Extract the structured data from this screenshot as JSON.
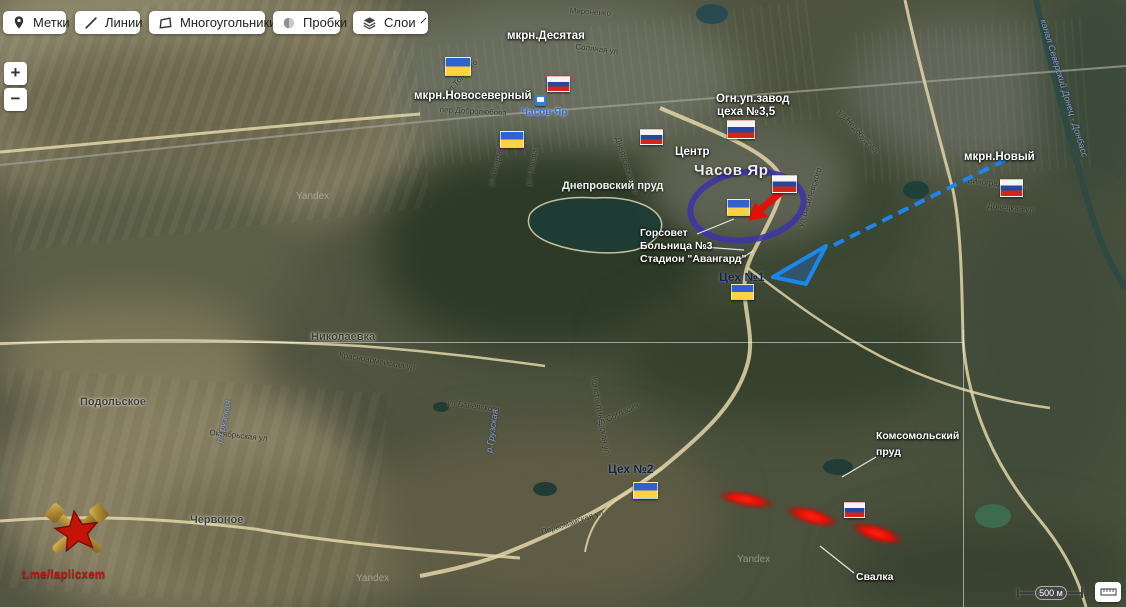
{
  "toolbar": {
    "buttons": [
      {
        "id": "marks",
        "label": "Метки",
        "icon": "pin-icon"
      },
      {
        "id": "lines",
        "label": "Линии",
        "icon": "line-icon"
      },
      {
        "id": "polygons",
        "label": "Многоугольники",
        "icon": "polygon-icon"
      },
      {
        "id": "traffic",
        "label": "Пробки",
        "icon": "traffic-icon"
      },
      {
        "id": "layers",
        "label": "Слои",
        "icon": "layers-icon",
        "has_dropdown": true
      }
    ]
  },
  "zoom": {
    "in": "+",
    "out": "−"
  },
  "scalebar": {
    "label": "500 м"
  },
  "logo": {
    "text": "t.me/laplicxem"
  },
  "map": {
    "city_labels": [
      {
        "text": "Часов Яр",
        "x": 694,
        "y": 162
      }
    ],
    "settlement_labels": [
      {
        "text": "Николаевка",
        "x": 311,
        "y": 331
      },
      {
        "text": "Подольское",
        "x": 80,
        "y": 396
      },
      {
        "text": "Червоное",
        "x": 190,
        "y": 514
      }
    ],
    "water_labels": [
      {
        "text": "Днепровский пруд",
        "x": 562,
        "y": 180,
        "cls": "pond"
      },
      {
        "text": "канал Северский Донец - Донбасс",
        "x": 1048,
        "y": 18,
        "rot": 73,
        "cls": "river"
      },
      {
        "text": "р.Грузская",
        "x": 214,
        "y": 442,
        "rot": -78,
        "cls": "river"
      },
      {
        "text": "р.Грузская",
        "x": 484,
        "y": 452,
        "rot": -82,
        "cls": "river"
      }
    ],
    "station": {
      "text": "Часов Яр",
      "x": 521,
      "y": 107,
      "icon_x": 535,
      "icon_y": 95
    },
    "annotations": [
      {
        "text": "мкрн.Десятая",
        "x": 507,
        "y": 30,
        "cls": "white"
      },
      {
        "text": "мкрн.Новосеверный",
        "x": 414,
        "y": 90,
        "cls": "white"
      },
      {
        "text": "Огн.уп.завод",
        "x": 716,
        "y": 93,
        "cls": "white"
      },
      {
        "text": "цеха №3,5",
        "x": 717,
        "y": 106,
        "cls": "white"
      },
      {
        "text": "Центр",
        "x": 675,
        "y": 146,
        "cls": "white"
      },
      {
        "text": "мкрн.Новый",
        "x": 964,
        "y": 151,
        "cls": "white"
      },
      {
        "text": "Горсовет",
        "x": 640,
        "y": 227,
        "cls": "white-sm"
      },
      {
        "text": "Больница №3",
        "x": 640,
        "y": 240,
        "cls": "white-sm"
      },
      {
        "text": "Стадион \"Авангард\"",
        "x": 640,
        "y": 253,
        "cls": "white-sm"
      },
      {
        "text": "Комсомольский",
        "x": 876,
        "y": 430,
        "cls": "white-sm"
      },
      {
        "text": "пруд",
        "x": 876,
        "y": 446,
        "cls": "white-sm"
      },
      {
        "text": "Свалка",
        "x": 856,
        "y": 571,
        "cls": "white-sm"
      },
      {
        "text": "Цех №1",
        "x": 719,
        "y": 270,
        "cls": "dark"
      },
      {
        "text": "Цех №2",
        "x": 608,
        "y": 462,
        "cls": "dark"
      }
    ],
    "street_labels": [
      {
        "text": "Мироненко",
        "x": 570,
        "y": 6,
        "rot": 4
      },
      {
        "text": "Соляная ул",
        "x": 576,
        "y": 42,
        "rot": 7
      },
      {
        "text": "пер.Добролюбова",
        "x": 440,
        "y": 105,
        "rot": 3
      },
      {
        "text": "ул.Толстого",
        "x": 444,
        "y": 90,
        "rot": -48
      },
      {
        "text": "ул.Спартака",
        "x": 486,
        "y": 185,
        "rot": -75
      },
      {
        "text": "ул.Чехова",
        "x": 524,
        "y": 185,
        "rot": -80
      },
      {
        "text": "Днепровская ул",
        "x": 622,
        "y": 136,
        "rot": 72
      },
      {
        "text": "ул.Недобудова",
        "x": 843,
        "y": 108,
        "rot": 48
      },
      {
        "text": "ул.Василевского",
        "x": 796,
        "y": 225,
        "rot": -72
      },
      {
        "text": "Виноградная ул",
        "x": 968,
        "y": 176,
        "rot": 6
      },
      {
        "text": "Донецкая ул",
        "x": 988,
        "y": 201,
        "rot": 6
      },
      {
        "text": "Красноармейская ул",
        "x": 340,
        "y": 350,
        "rot": 10
      },
      {
        "text": "Константиновская ул",
        "x": 598,
        "y": 376,
        "rot": 80
      },
      {
        "text": "ул.Баневского",
        "x": 448,
        "y": 398,
        "rot": 8
      },
      {
        "text": "ул.Согласия",
        "x": 595,
        "y": 420,
        "rot": -25
      },
      {
        "text": "Октябрьская ул",
        "x": 210,
        "y": 428,
        "rot": 6
      },
      {
        "text": "Первомайская ул",
        "x": 540,
        "y": 528,
        "rot": -18
      }
    ],
    "watermarks": [
      {
        "text": "Yandex",
        "x": 296,
        "y": 191
      },
      {
        "text": "Yandex",
        "x": 356,
        "y": 573
      },
      {
        "text": "Yandex",
        "x": 737,
        "y": 554
      }
    ],
    "flags": [
      {
        "type": "ua",
        "x": 445,
        "y": 57,
        "w": 26,
        "h": 19
      },
      {
        "type": "ua",
        "x": 500,
        "y": 131,
        "w": 24,
        "h": 17
      },
      {
        "type": "ua",
        "x": 727,
        "y": 199,
        "w": 23,
        "h": 17
      },
      {
        "type": "ua",
        "x": 731,
        "y": 284,
        "w": 23,
        "h": 16
      },
      {
        "type": "ua",
        "x": 633,
        "y": 482,
        "w": 25,
        "h": 17
      },
      {
        "type": "ru",
        "x": 547,
        "y": 76,
        "w": 23,
        "h": 16
      },
      {
        "type": "ru",
        "x": 640,
        "y": 129,
        "w": 23,
        "h": 16
      },
      {
        "type": "ru",
        "x": 727,
        "y": 120,
        "w": 28,
        "h": 19
      },
      {
        "type": "ru",
        "x": 772,
        "y": 175,
        "w": 25,
        "h": 18
      },
      {
        "type": "ru",
        "x": 1000,
        "y": 179,
        "w": 23,
        "h": 18
      },
      {
        "type": "ru",
        "x": 844,
        "y": 502,
        "w": 21,
        "h": 16
      }
    ]
  },
  "overlays": {
    "ellipse": {
      "cx": 747,
      "cy": 206,
      "rx": 57,
      "ry": 34,
      "rot": -8,
      "color": "#3c34a9"
    },
    "red_arrow": {
      "shaft": [
        [
          786,
          188
        ],
        [
          761,
          209
        ]
      ],
      "head": [
        [
          748,
          221
        ],
        [
          755,
          202
        ],
        [
          768,
          217
        ]
      ],
      "color": "#e31006"
    },
    "blue_arrow": {
      "line": [
        [
          1005,
          160
        ],
        [
          830,
          247
        ]
      ],
      "head": [
        [
          773,
          277
        ],
        [
          826,
          246
        ],
        [
          806,
          284
        ]
      ],
      "color": "#1b86ec"
    },
    "strikes": [
      {
        "x": 717,
        "y": 492,
        "w": 58,
        "h": 15,
        "rot": 10
      },
      {
        "x": 784,
        "y": 508,
        "w": 56,
        "h": 17,
        "rot": 16
      },
      {
        "x": 849,
        "y": 525,
        "w": 56,
        "h": 17,
        "rot": 17
      }
    ],
    "leaders": [
      [
        697,
        234,
        734,
        219
      ],
      [
        703,
        247,
        744,
        250
      ],
      [
        737,
        261,
        753,
        251
      ],
      [
        876,
        457,
        842,
        477
      ],
      [
        854,
        573,
        820,
        546
      ]
    ]
  }
}
